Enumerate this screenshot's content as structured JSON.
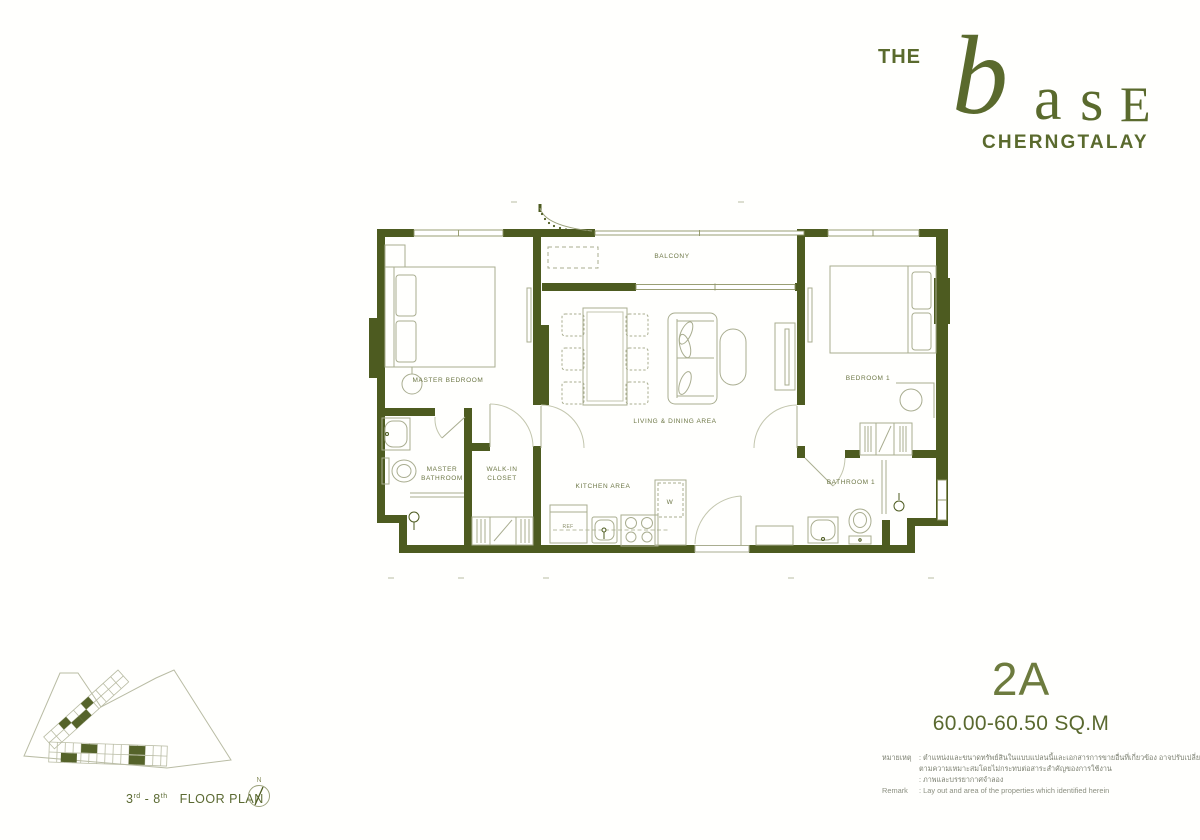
{
  "colors": {
    "brand": "#5a6a2d",
    "wall": "#4d5b20",
    "furniture_line": "#a9ad90",
    "label": "#6d7746"
  },
  "logo": {
    "the": "THE",
    "b": "b",
    "a": "a",
    "s": "s",
    "e": "E",
    "subtitle": "CHERNGTALAY"
  },
  "plan": {
    "rooms": {
      "master_bedroom": "MASTER BEDROOM",
      "balcony": "BALCONY",
      "bedroom1": "BEDROOM 1",
      "living_dining": "LIVING & DINING AREA",
      "master_bathroom_line1": "MASTER",
      "master_bathroom_line2": "BATHROOM",
      "walk_in_closet_line1": "WALK-IN",
      "walk_in_closet_line2": "CLOSET",
      "kitchen": "KITCHEN AREA",
      "bathroom1": "BATHROOM 1"
    },
    "appliances": {
      "ref": "REF",
      "washer": "W"
    }
  },
  "key_plan": {
    "floor_start": "3",
    "sup_start": "rd",
    "floor_mid": "- 8",
    "sup_end": "th",
    "label": "FLOOR PLAN",
    "north": "N"
  },
  "unit": {
    "name": "2A",
    "area": "60.00-60.50 SQ.M"
  },
  "remark": {
    "thai_label": "หมายเหตุ",
    "thai_line1": ": ตำแหน่งและขนาดทรัพย์สินในแบบแปลนนี้และเอกสารการขายอื่นที่เกี่ยวข้อง อาจปรับเปลี่ยนได้",
    "thai_line2": "ตามความเหมาะสมโดยไม่กระทบต่อสาระสำคัญของการใช้งาน",
    "thai_line3": ": ภาพและบรรยากาศจำลอง",
    "en_label": "Remark",
    "en_line": ": Lay out and area of the properties which identified herein"
  }
}
